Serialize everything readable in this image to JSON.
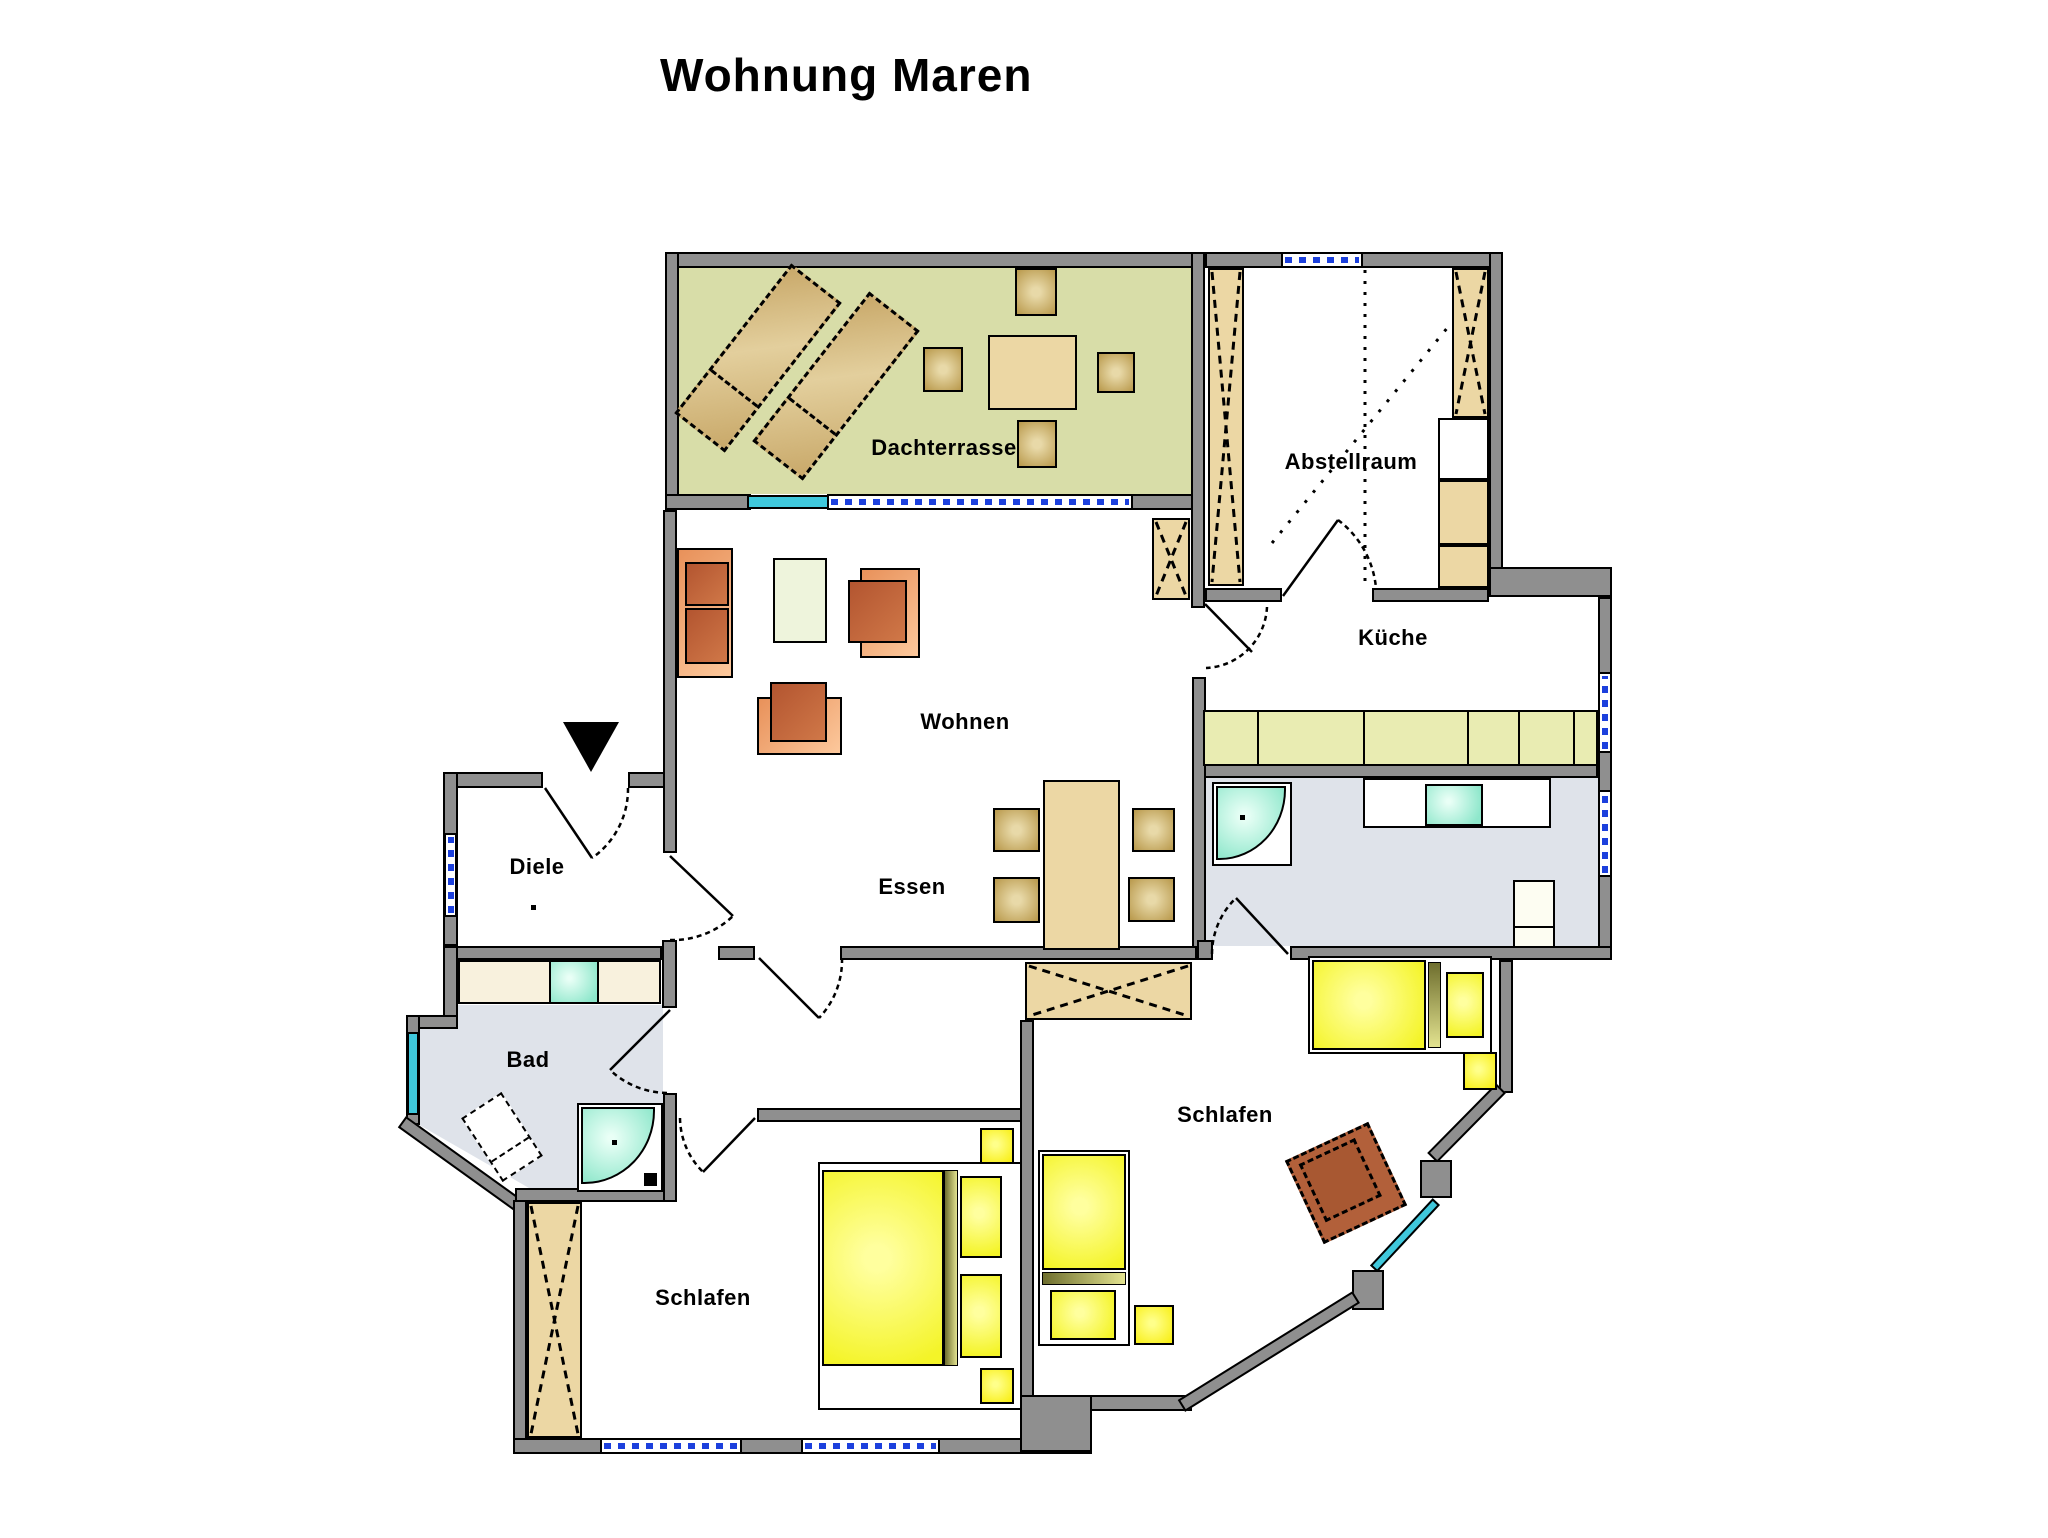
{
  "title": "Wohnung Maren",
  "rooms": {
    "dachterrasse": {
      "label": "Dachterrasse"
    },
    "abstellraum": {
      "label": "Abstellraum"
    },
    "wohnen": {
      "label": "Wohnen"
    },
    "essen": {
      "label": "Essen"
    },
    "kueche": {
      "label": "Küche"
    },
    "diele": {
      "label": "Diele"
    },
    "bad": {
      "label": "Bad"
    },
    "schlafen_links": {
      "label": "Schlafen"
    },
    "schlafen_rechts": {
      "label": "Schlafen"
    }
  },
  "colors": {
    "wall": "#8f8f8f",
    "terrace_green": "#d8dda8",
    "wood_light": "#ecd7a4",
    "wood_dark": "#bb9c50",
    "counter_green": "#e9ecb2",
    "bath_floor": "#dfe3ea",
    "fixture_teal": "#8ee7cb",
    "window_blue": "#1c40dd",
    "window_cyan": "#3fc8dc",
    "sofa_orange": "#f0a26b",
    "cushion_rust": "#c06038",
    "bed_yellow": "#f4f428",
    "nightstand_yellow": "#f8ee12",
    "headboard_olive": "#9a9a4d",
    "armchair_brown": "#b2603a",
    "counter_cream": "#f8f1dd",
    "coffee_table_green": "#eef4dc"
  }
}
